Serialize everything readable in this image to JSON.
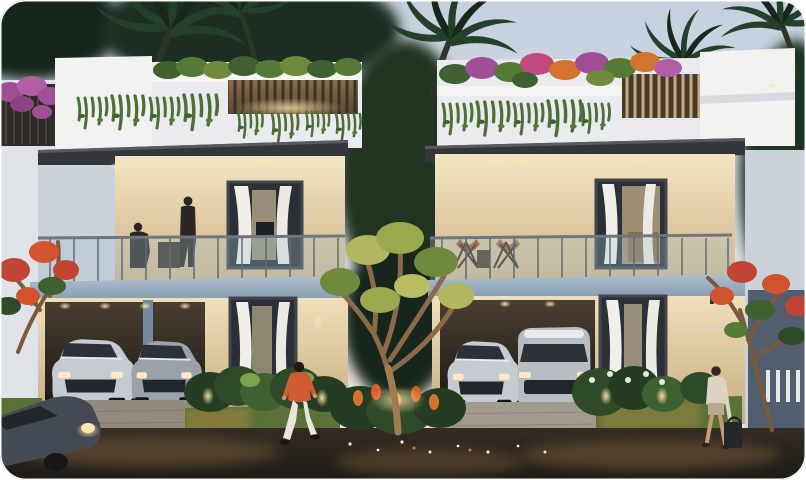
{
  "scene": {
    "type": "architectural-dusk-render",
    "description": "Twin modern white villas at dusk with rooftop gardens, glass balconies, carports with parked silver cars, tropical landscaping and pedestrians",
    "house_number": "005"
  },
  "colors": {
    "sky_top": "#c5d0df",
    "sky_mid": "#dadce2",
    "sky_horizon": "#ecdfd7",
    "white_lit": "#f2f2f1",
    "white_shade": "#dfe2e7",
    "white_cool": "#ccd2da",
    "fascia": "#33363b",
    "slab_top": "#a9bbce",
    "slab_bot": "#8da3b9",
    "warm_hi": "#f7e8c6",
    "warm_lo": "#d2ba8e",
    "interior_glow": "#ffdf9e",
    "pergola_bg": "#6b5538",
    "pergola_slat_dark": "#3a3228",
    "pergola_slat_light": "#c2ab85",
    "canopy_dark": "#17271b",
    "canopy_mid": "#24402a",
    "leaf_light": "#7ca24d",
    "leaf_yellow": "#b0b75f",
    "vine_green": "#4e7038",
    "grass": "#5a7137",
    "grass_warm": "#93803f",
    "shrub_dark": "#243c22",
    "flower_purple": "#a04f97",
    "flower_orange": "#d2742d",
    "flower_red": "#c14434",
    "flower_white": "#e8e8df",
    "road_dark": "#262019",
    "road_warm": "#86663e",
    "paver": "#948b80",
    "car_silver": "#c6cbd1",
    "car_silver_dark": "#9aa1a9",
    "car_window": "#2c3138",
    "car_dark": "#434a53",
    "wheel": "#15161a",
    "skin": "#c89b78",
    "shirt_orange": "#cf5c33",
    "pants_white": "#e9e5dc",
    "figure_dark": "#2b2623",
    "chair_brown": "#955731",
    "glass_rail": "rgba(165,195,210,0.30)",
    "rail_post": "#646b72",
    "number_text": "#d8d2c4",
    "fence_white": "#e6e8ea",
    "wall_blue": "#3c4a5a"
  }
}
